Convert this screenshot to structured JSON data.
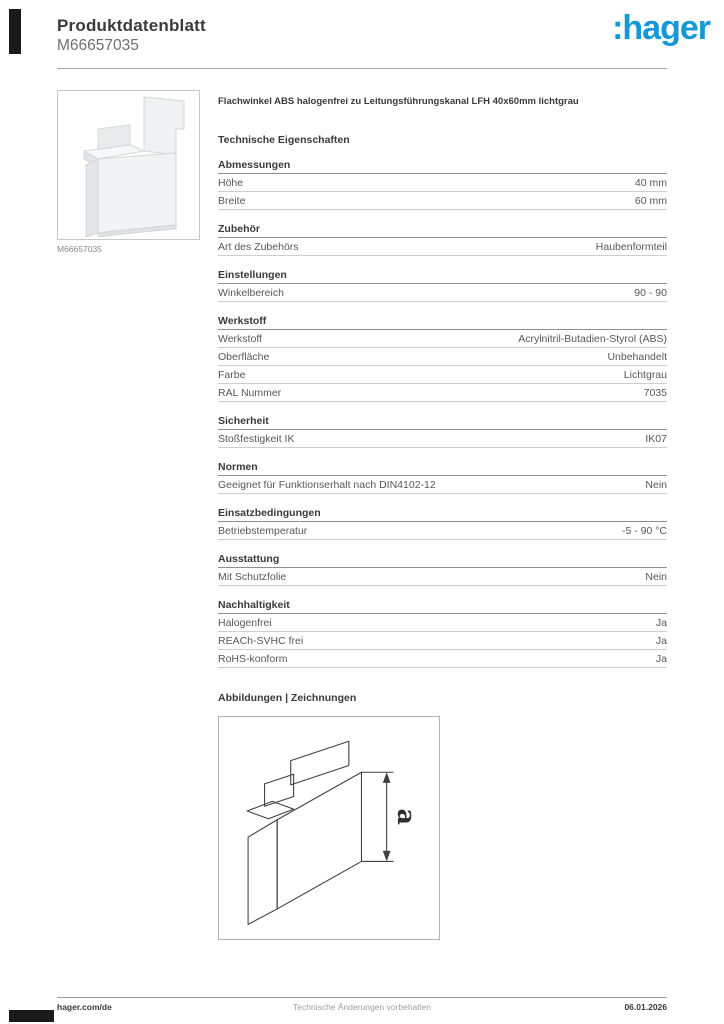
{
  "header": {
    "title": "Produktdatenblatt",
    "product_id": "M66657035",
    "logo_text": ":hager"
  },
  "colors": {
    "brand_blue": "#1598d6",
    "text_dark": "#3a3a3a",
    "text_gray": "#6f6f6f",
    "line_light": "#cecece",
    "line_dark": "#8f8f8f"
  },
  "product": {
    "description": "Flachwinkel ABS halogenfrei zu Leitungsführungskanal LFH 40x60mm lichtgrau",
    "image_caption": "M66657035",
    "photo_icon": "corner-trunking-piece"
  },
  "specs": {
    "heading": "Technische Eigenschaften",
    "sections": [
      {
        "title": "Abmessungen",
        "rows": [
          [
            "Höhe",
            "40 mm"
          ],
          [
            "Breite",
            "60 mm"
          ]
        ]
      },
      {
        "title": "Zubehör",
        "rows": [
          [
            "Art des Zubehörs",
            "Haubenformteil"
          ]
        ]
      },
      {
        "title": "Einstellungen",
        "rows": [
          [
            "Winkelbereich",
            "90 - 90"
          ]
        ]
      },
      {
        "title": "Werkstoff",
        "rows": [
          [
            "Werkstoff",
            "Acrylnitril-Butadien-Styrol (ABS)"
          ],
          [
            "Oberfläche",
            "Unbehandelt"
          ],
          [
            "Farbe",
            "Lichtgrau"
          ],
          [
            "RAL Nummer",
            "7035"
          ]
        ]
      },
      {
        "title": "Sicherheit",
        "rows": [
          [
            "Stoßfestigkeit IK",
            "IK07"
          ]
        ]
      },
      {
        "title": "Normen",
        "rows": [
          [
            "Geeignet für Funktionserhalt nach DIN4102-12",
            "Nein"
          ]
        ]
      },
      {
        "title": "Einsatzbedingungen",
        "rows": [
          [
            "Betriebstemperatur",
            "-5 - 90 °C"
          ]
        ]
      },
      {
        "title": "Ausstattung",
        "rows": [
          [
            "Mit Schutzfolie",
            "Nein"
          ]
        ]
      },
      {
        "title": "Nachhaltigkeit",
        "rows": [
          [
            "Halogenfrei",
            "Ja"
          ],
          [
            "REACh-SVHC frei",
            "Ja"
          ],
          [
            "RoHS-konform",
            "Ja"
          ]
        ]
      }
    ]
  },
  "drawings": {
    "heading": "Abbildungen | Zeichnungen",
    "dimension_label": "a"
  },
  "footer": {
    "website": "hager.com/de",
    "notice": "Technische Änderungen vorbehalten",
    "date": "06.01.2026"
  }
}
